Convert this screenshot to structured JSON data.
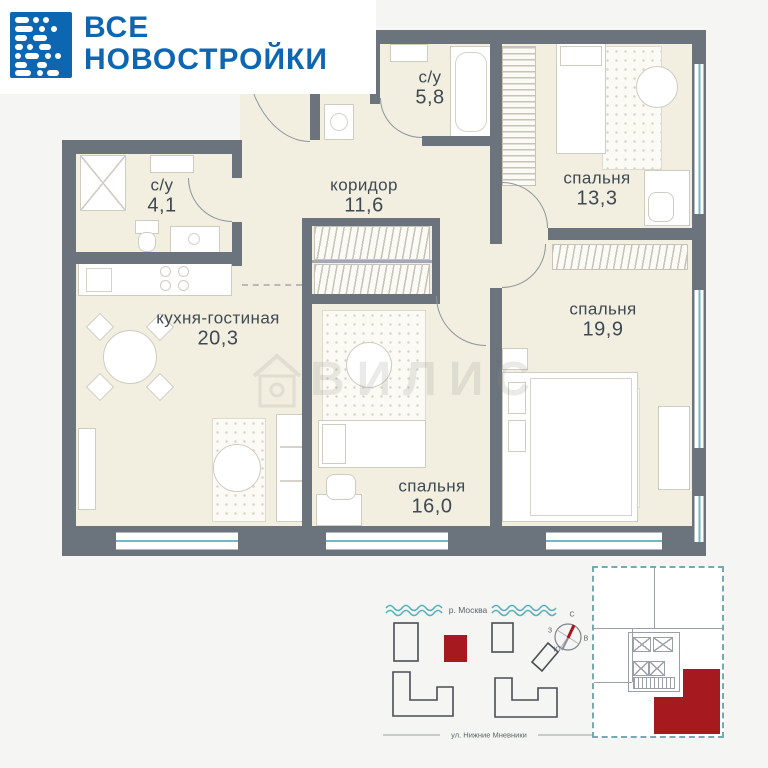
{
  "logo": {
    "line1": "ВСЕ",
    "line2": "НОВОСТРОЙКИ"
  },
  "plan": {
    "rooms": [
      {
        "name": "с/у",
        "area": "4,1"
      },
      {
        "name": "с/у",
        "area": "5,8"
      },
      {
        "name": "коридор",
        "area": "11,6"
      },
      {
        "name": "спальня",
        "area": "13,3"
      },
      {
        "name": "спальня",
        "area": "19,9"
      },
      {
        "name": "кухня-гостиная",
        "area": "20,3"
      },
      {
        "name": "спальня",
        "area": "16,0"
      }
    ],
    "watermark": "ВИЛИС"
  },
  "site_plan": {
    "river_label": "р. Москва",
    "street_label": "ул. Нижние Мневники",
    "compass": {
      "north": "С",
      "south": "Ю",
      "west": "З",
      "east": "В"
    }
  },
  "colors": {
    "logo_blue": "#0d66b1",
    "wall_gray": "#6b747d",
    "floor_cream": "#f2efe1",
    "window_teal": "#6fb9c4",
    "accent_red": "#a6191f"
  }
}
